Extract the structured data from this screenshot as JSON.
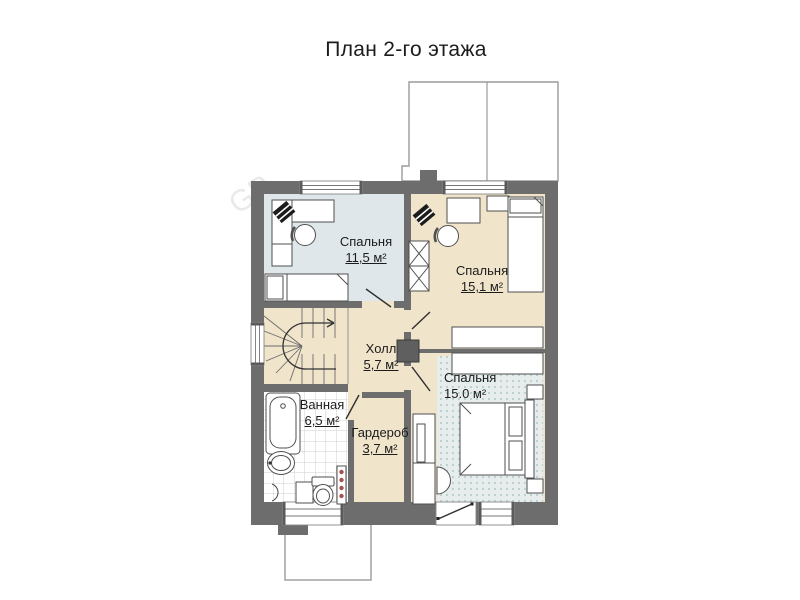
{
  "title": "План 2-го этажа",
  "floor_plan": {
    "rooms": [
      {
        "id": "bedroom-1",
        "name": "Спальня",
        "area": "11,5 м²"
      },
      {
        "id": "bedroom-2",
        "name": "Спальня",
        "area": "15,1 м²"
      },
      {
        "id": "hall",
        "name": "Холл",
        "area": "5,7 м²"
      },
      {
        "id": "bedroom-3",
        "name": "Спальня",
        "area": "15.0 м²"
      },
      {
        "id": "bathroom",
        "name": "Ванная",
        "area": "6,5 м²"
      },
      {
        "id": "wardrobe",
        "name": "Гардероб",
        "area": "3,7 м²"
      }
    ],
    "watermark": "GP",
    "colors": {
      "wall": "#6d6d6d",
      "floor_beige": "#f0e5cb",
      "bedroom1_floor": "#e0e7ea",
      "tile_grid": "#cfcfcf",
      "rug_base": "#e7eded",
      "rug_dots": "#b9cdcd",
      "roof_outline": "#9b9b9b",
      "towel_rail_dots": "#a35050"
    }
  }
}
